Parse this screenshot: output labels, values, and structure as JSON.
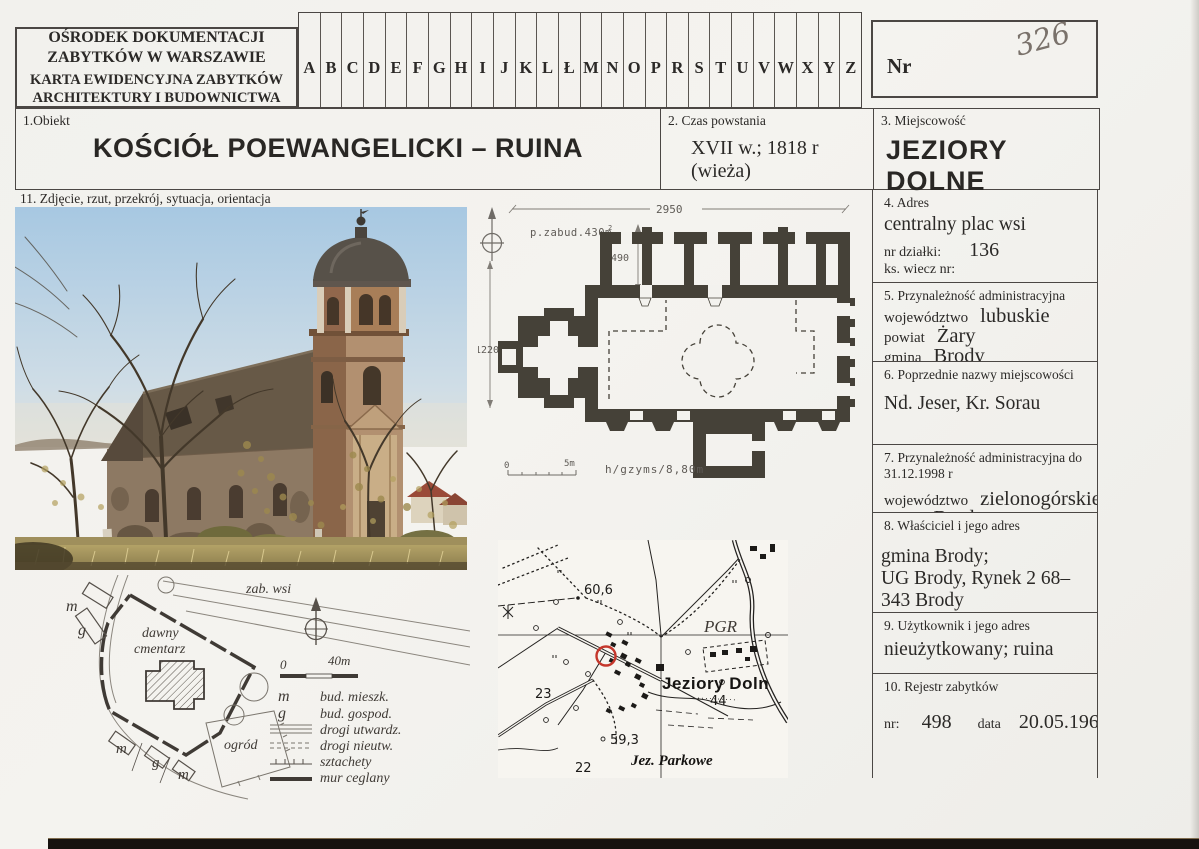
{
  "colors": {
    "paper": "#f3f2ee",
    "ink": "#2b2927",
    "line": "#4b4744",
    "accent_red": "#c5372c",
    "handwriting": "#7a726b"
  },
  "header": {
    "org_line1": "OŚRODEK DOKUMENTACJI",
    "org_line2": "ZABYTKÓW W WARSZAWIE",
    "card_line1": "KARTA EWIDENCYJNA ZABYTKÓW",
    "card_line2": "ARCHITEKTURY I BUDOWNICTWA",
    "alphabet": [
      "A",
      "B",
      "C",
      "D",
      "E",
      "F",
      "G",
      "H",
      "I",
      "J",
      "K",
      "L",
      "Ł",
      "M",
      "N",
      "O",
      "P",
      "R",
      "S",
      "T",
      "U",
      "V",
      "W",
      "X",
      "Y",
      "Z"
    ],
    "nr_label": "Nr",
    "nr_value": "326"
  },
  "object": {
    "label": "1.Obiekt",
    "name": "KOŚCIÓŁ POEWANGELICKI – RUINA"
  },
  "czas": {
    "label": "2. Czas powstania",
    "value": "XVII w.; 1818 r (wieża)"
  },
  "miejscowosc": {
    "label": "3. Miejscowość",
    "value": "JEZIORY DOLNE"
  },
  "section11": {
    "label": "11. Zdjęcie, rzut, przekrój, sytuacja, orientacja"
  },
  "plan": {
    "dim_top": "2950",
    "dim_wing": "490",
    "dim_left": "1220",
    "area": "p.zabud.430m",
    "area_sup": "2",
    "scale_zero": "0",
    "scale_end": "5m",
    "height_note": "h/gzyms/8,80m"
  },
  "sketch": {
    "zab_wsi": "zab. wsi",
    "cmentarz_line1": "dawny",
    "cmentarz_line2": "cmentarz",
    "ogrod": "ogród",
    "letters": [
      "m",
      "g",
      "m",
      "g",
      "m"
    ],
    "scale_zero": "0",
    "scale_end": "40m",
    "legend": [
      {
        "sym": "m",
        "label": "bud. mieszk."
      },
      {
        "sym": "g",
        "label": "bud. gospod."
      },
      {
        "sym": "lines",
        "label": "drogi utwardz."
      },
      {
        "sym": "dashes",
        "label": "drogi nieutw."
      },
      {
        "sym": "fence",
        "label": "sztachety"
      },
      {
        "sym": "wall",
        "label": "mur ceglany"
      }
    ]
  },
  "map": {
    "elev1": "60,6",
    "pgr": "PGR",
    "town": "Jeziory Doln",
    "n44": "44",
    "n23": "23",
    "elev2": "59,3",
    "n22": "22",
    "lake": "Jez. Parkowe"
  },
  "right": {
    "s4": {
      "label": "4. Adres",
      "value": "centralny plac wsi",
      "plot_label": "nr działki:",
      "plot": "136",
      "kw_label": "ks. wiecz nr:"
    },
    "s5": {
      "label": "5. Przynależność administracyjna",
      "rows": [
        {
          "k": "województwo",
          "v": "lubuskie"
        },
        {
          "k": "powiat",
          "v": "Żary"
        },
        {
          "k": "gmina",
          "v": "Brody"
        }
      ]
    },
    "s6": {
      "label": "6. Poprzednie nazwy miejscowości",
      "value": "Nd. Jeser, Kr. Sorau"
    },
    "s7": {
      "label": "7. Przynależność administracyjna do 31.12.1998 r",
      "rows": [
        {
          "k": "województwo",
          "v": "zielonogórskie"
        },
        {
          "k": "gmina",
          "v": "Brody"
        }
      ]
    },
    "s8": {
      "label": "8. Właściciel i jego adres",
      "line1": "gmina Brody;",
      "line2": "UG Brody, Rynek 2 68–343 Brody"
    },
    "s9": {
      "label": "9. Użytkownik i jego adres",
      "value": "nieużytkowany; ruina"
    },
    "s10": {
      "label": "10. Rejestr zabytków",
      "nr_label": "nr:",
      "nr": "498",
      "date_label": "data",
      "date": "20.05.1963"
    }
  }
}
